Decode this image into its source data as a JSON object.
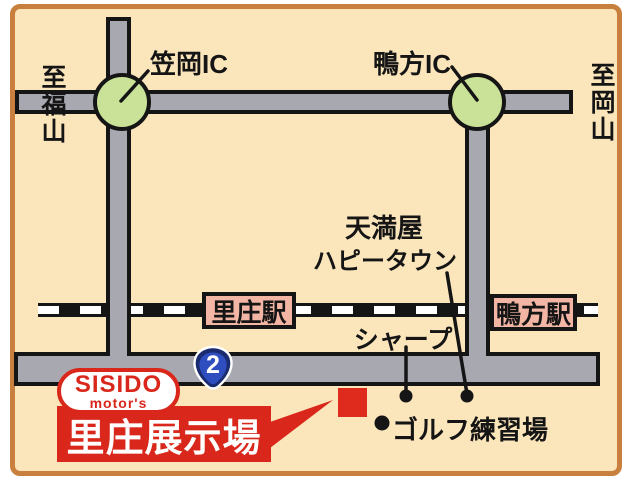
{
  "edges": {
    "left_destination": "至福山",
    "right_destination": "至岡山"
  },
  "interchanges": {
    "kasaoka": "笠岡IC",
    "kamogata": "鴨方IC"
  },
  "stations": {
    "satosho": "里庄駅",
    "kamogata": "鴨方駅"
  },
  "landmarks": {
    "tenmaya_line1": "天満屋",
    "tenmaya_line2": "ハピータウン",
    "sharp": "シャープ",
    "golf": "ゴルフ練習場"
  },
  "route": {
    "number": "2"
  },
  "dealer": {
    "brand_top": "SISIDO",
    "brand_bottom": "motor's",
    "site": "里庄展示場"
  },
  "colors": {
    "map_background": "#fbe5bb",
    "map_border": "#c9803f",
    "road_gray": "#a8a8b0",
    "outline_black": "#151515",
    "ic_green": "#c9e297",
    "station_pink": "#f3b5a4",
    "brand_red": "#d9281b",
    "route_navy": "#1b2b6f",
    "route_blue": "#2e4ec0"
  }
}
